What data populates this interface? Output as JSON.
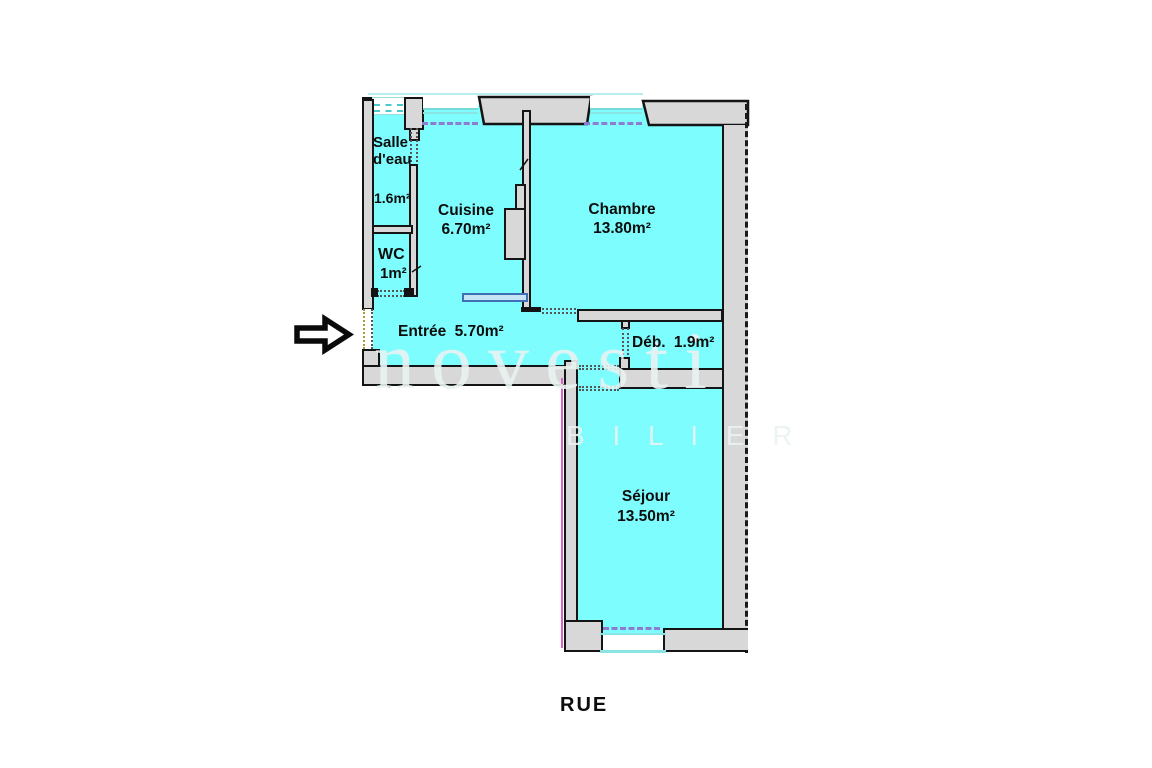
{
  "plan_title": "apartment-floor-plan",
  "rooms": {
    "salle_deau": {
      "name_line1": "Salle",
      "name_line2": "d'eau",
      "area": "1.6m²"
    },
    "wc": {
      "name": "WC",
      "area": "1m²"
    },
    "cuisine": {
      "name": "Cuisine",
      "area": "6.70m²"
    },
    "chambre": {
      "name": "Chambre",
      "area": "13.80m²"
    },
    "entree": {
      "name": "Entrée",
      "area": "5.70m²"
    },
    "debarras": {
      "name": "Déb.",
      "area": "1.9m²"
    },
    "sejour": {
      "name": "Séjour",
      "area": "13.50m²"
    }
  },
  "street_label": "RUE",
  "watermark": {
    "line1": "novesti",
    "line2": "B I L I E R"
  },
  "colors": {
    "room_fill": "#7dfdfe",
    "wall_fill": "#d8d8d8",
    "outline": "#141414",
    "window_line": "#77d8d8",
    "beam_dash": "#8d7cd2",
    "boundary_dash": "#1a1a1a",
    "radiator_outline": "#3f6fb5",
    "edge_magenta": "#d465c8"
  }
}
